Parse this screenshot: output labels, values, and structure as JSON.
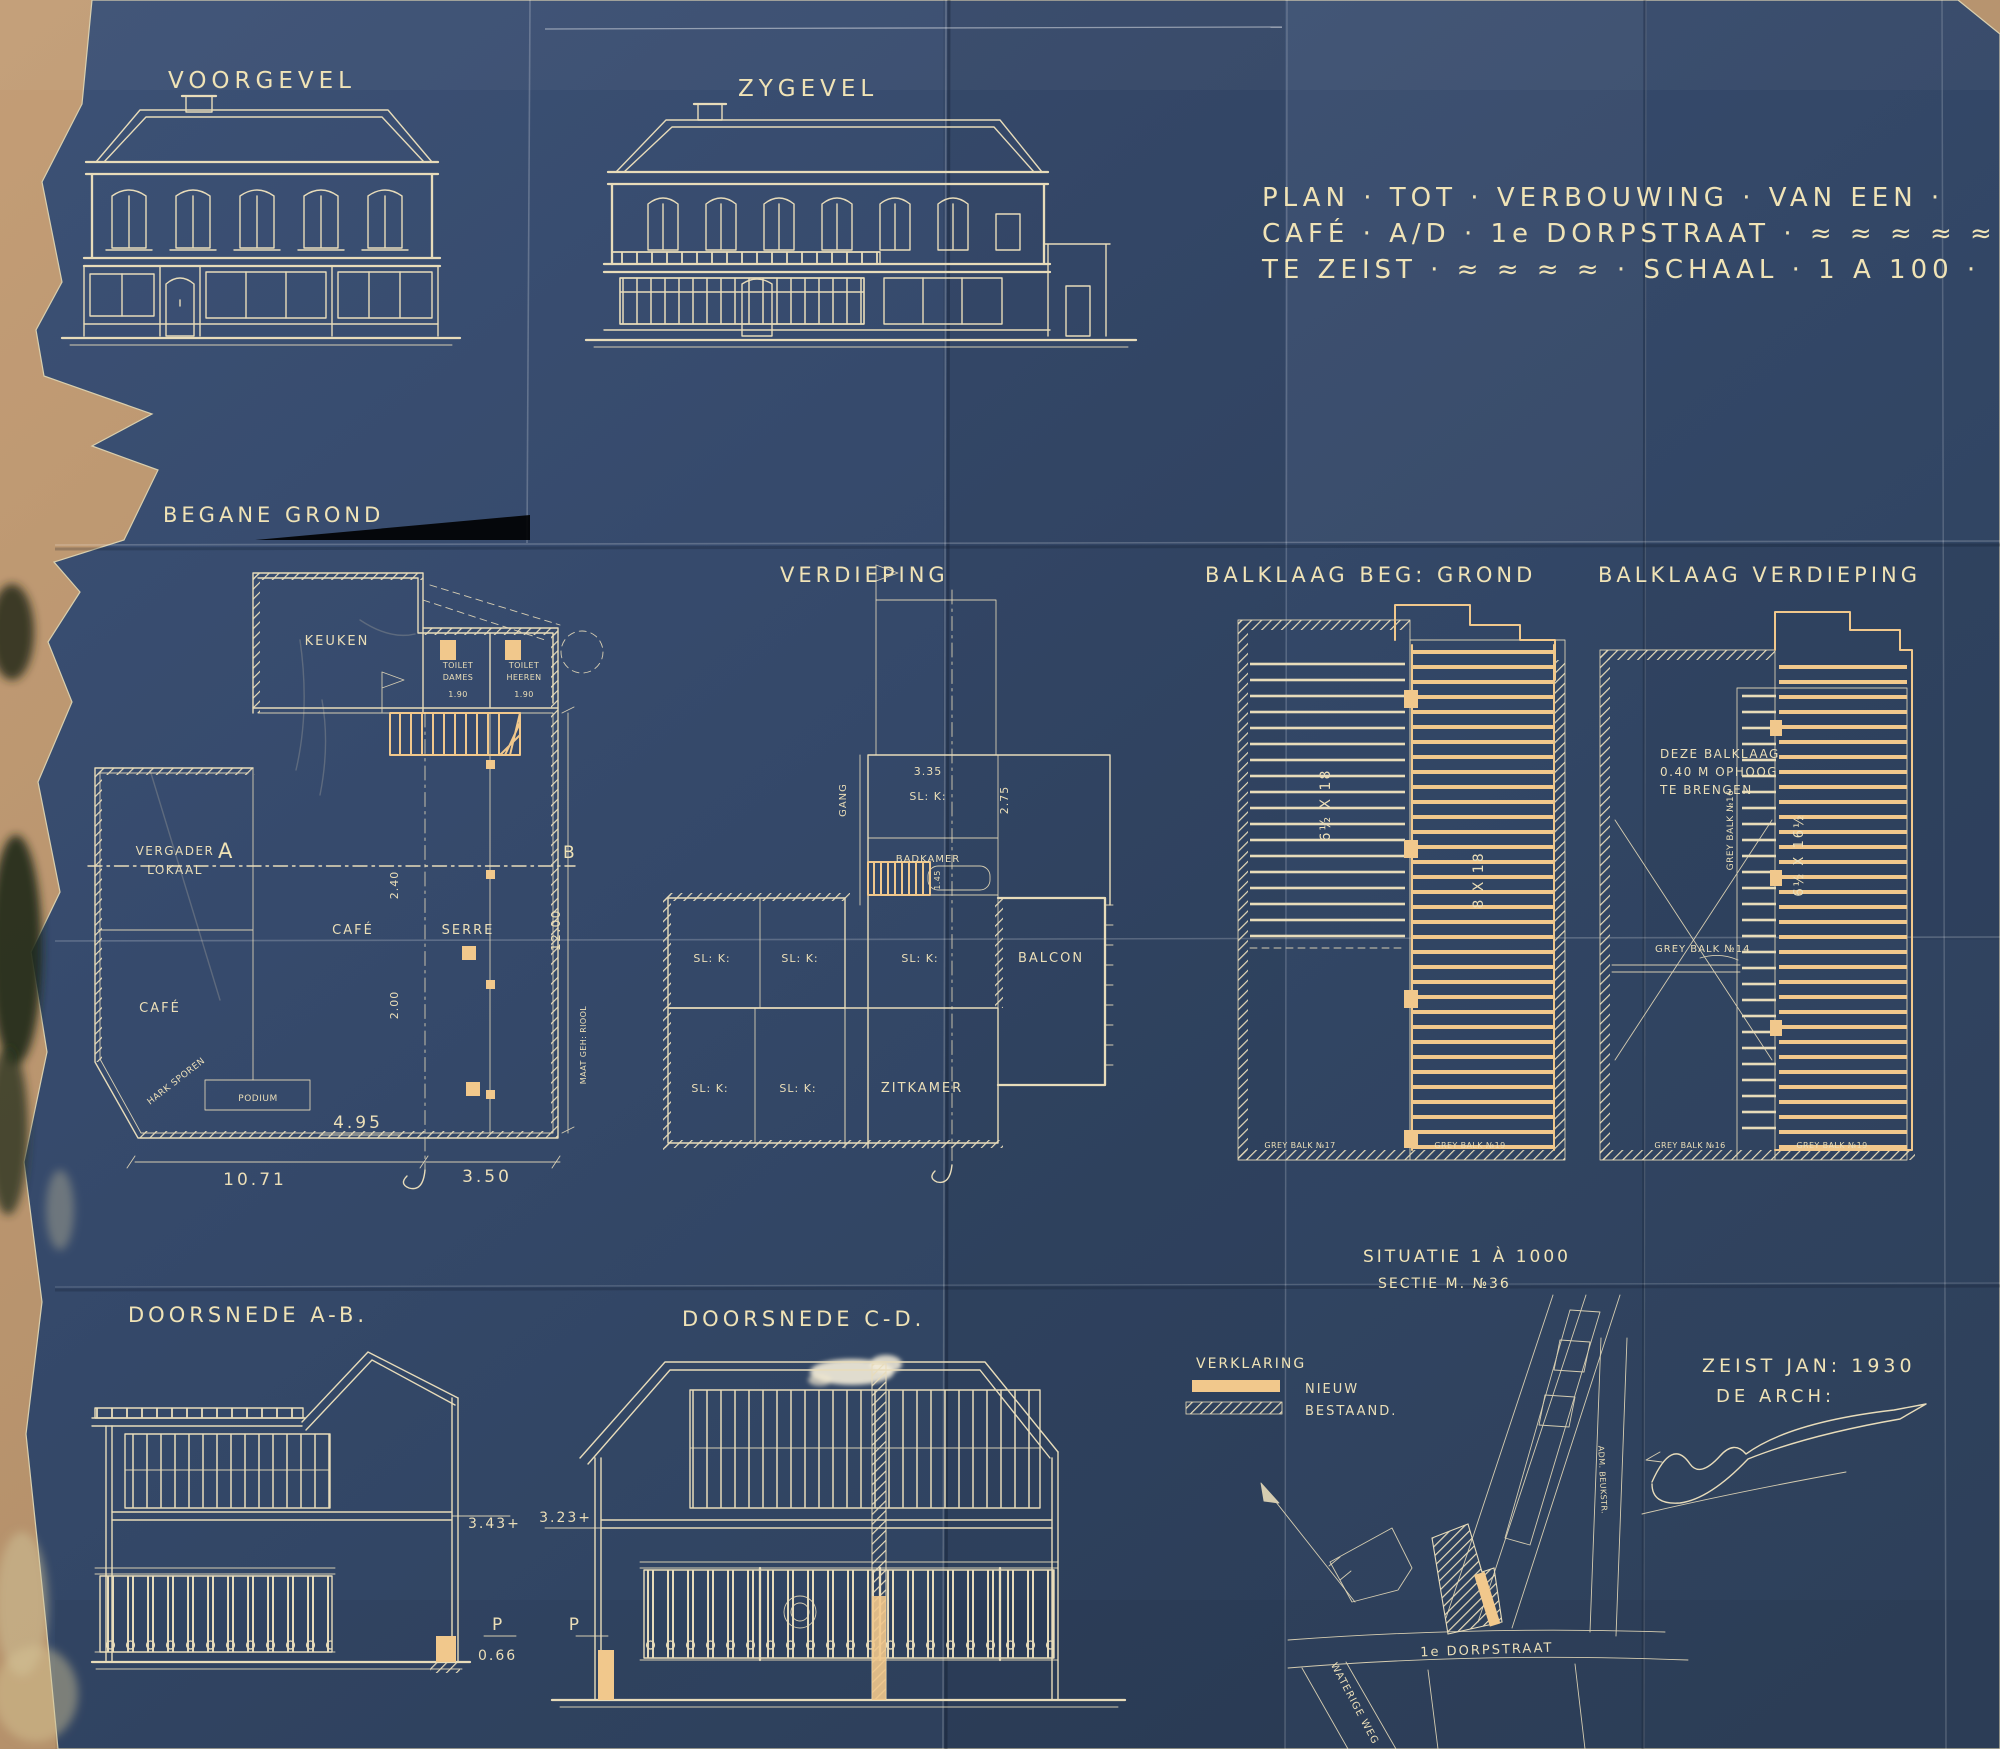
{
  "colors": {
    "paper_blue": "#35496b",
    "cardboard_tan": "#b5926e",
    "line_cream": "#e8dcba",
    "new_work_orange": "#f1c88c"
  },
  "elevations": {
    "front": "VOORGEVEL",
    "side": "ZYGEVEL"
  },
  "title_block": {
    "line1": "PLAN · TOT · VERBOUWING · VAN EEN ·",
    "line2": "CAFÉ · A/D · 1e DORPSTRAAT · ≈ ≈ ≈ ≈ ≈",
    "line3": "TE ZEIST · ≈ ≈ ≈ ≈ · SCHAAL · 1 A 100 ·"
  },
  "ground_floor": {
    "label": "BEGANE GROND",
    "rooms": {
      "keuken": "KEUKEN",
      "toilet1a": "TOILET",
      "toilet1b": "DAMES",
      "toilet2a": "TOILET",
      "toilet2b": "HEEREN",
      "vergader1": "VERGADER",
      "vergader2": "LOKAAL",
      "cafe_left": "CAFÉ",
      "cafe_mid": "CAFÉ",
      "serre": "SERRE",
      "podium": "PODIUM",
      "boundary_note": "HARK SPOREN"
    },
    "marks": {
      "section_a": "A",
      "section_b": "B"
    },
    "dims": {
      "w_main": "10.71",
      "w_serre": "3.50",
      "w_inner": "4.95",
      "d1": "2.40",
      "d2": "2.00",
      "h_right": "12.00",
      "riool": "MAAT GEH: RIOOL",
      "toilet": "1.90"
    }
  },
  "first_floor": {
    "label": "VERDIEPING",
    "rooms": {
      "gang": "GANG",
      "slaapkamer": "SL: K:",
      "badkamer": "BADKAMER",
      "balcon": "BALCON",
      "zitkamer": "ZITKAMER"
    },
    "dims": {
      "w_top": "3.35",
      "d_top": "2.75",
      "d_mid": "1.45"
    }
  },
  "joists_ground": {
    "label": "BALKLAAG BEG: GROND",
    "joist_left": "6½ X 18",
    "joist_right": "8 X 18",
    "beam_b1": "GREY BALK №17",
    "beam_b2": "GREY BALK №19"
  },
  "joists_first": {
    "label": "BALKLAAG VERDIEPING",
    "note1": "DEZE BALKLAAG",
    "note2": "0.40 M OPHOOG",
    "note3": "TE BRENGEN",
    "beam16": "GREY BALK №16",
    "beam14": "GREY BALK №14",
    "joist": "6½ X 16½",
    "beam_b1": "GREY BALK №16",
    "beam_b2": "GREY BALK №19"
  },
  "section_ab": {
    "label": "DOORSNEDE A-B.",
    "dim_floor": "3.43+",
    "datum": "P",
    "dim_base": "0.66"
  },
  "section_cd": {
    "label": "DOORSNEDE C-D.",
    "dim_floor": "3.23+",
    "datum": "P"
  },
  "legend": {
    "title": "VERKLARING",
    "new": "NIEUW",
    "existing": "BESTAAND."
  },
  "situation": {
    "title": "SITUATIE 1 À 1000",
    "subtitle": "SECTIE M. №36",
    "street_main": "1e DORPSTRAAT",
    "street_left": "WATERIGE WEG",
    "street_right": "ADM. BEUKSTR."
  },
  "colophon": {
    "place_date": "ZEIST JAN: 1930",
    "architect": "DE ARCH:"
  }
}
